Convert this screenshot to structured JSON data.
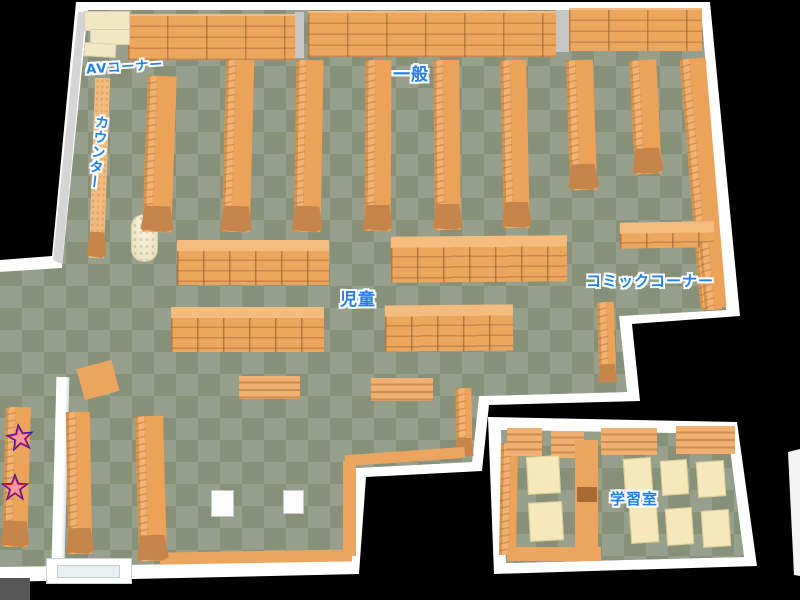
{
  "floor_map": {
    "background": "#000000",
    "colors": {
      "floor_light": "#96a08c",
      "floor_dark": "#879179",
      "shelf_orange": "#eca65e",
      "shelf_dark": "#c9874a",
      "wall_white": "#ffffff",
      "beige_shelf": "#f2e7c4",
      "table_cream": "#f6e8ba",
      "label_blue": "#1e7ff2",
      "star_fill": "#f598a0",
      "star_ring": "#cc2233",
      "star_outline": "#2216cc"
    },
    "labels": {
      "av": "AVコーナー",
      "general": "一般",
      "counter": "カウンター",
      "children": "児童",
      "comic": "コミックコーナー",
      "study": "学習室"
    },
    "markers": {
      "star_count": 2
    }
  }
}
